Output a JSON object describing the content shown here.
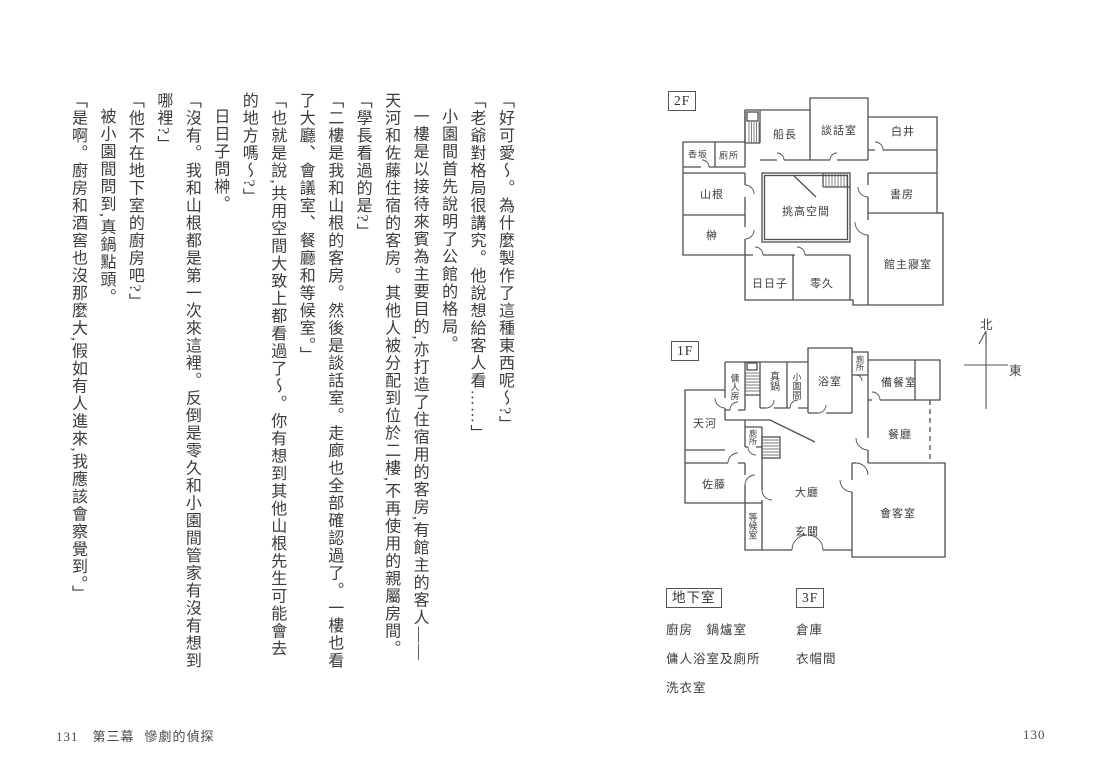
{
  "page_left": {
    "paragraphs": [
      {
        "text": "「好可愛〜。為什麼製作了這種東西呢〜?」",
        "indent": false
      },
      {
        "text": "「老爺對格局很講究。他說想給客人看……」",
        "indent": false
      },
      {
        "text": "小園間首先說明了公館的格局。",
        "indent": true
      },
      {
        "text": "一樓是以接待來賓為主要目的,亦打造了住宿用的客房,有館主的客人——天河和佐藤住宿的客房。其他人被分配到位於二樓,不再使用的親屬房間。",
        "indent": true
      },
      {
        "text": "「學長看過的是?」",
        "indent": false
      },
      {
        "text": "「二樓是我和山根的客房。然後是談話室。走廊也全部確認過了。一樓也看了大廳、會議室、餐廳和等候室。」",
        "indent": false
      },
      {
        "text": "「也就是說,共用空間大致上都看過了〜。你有想到其他山根先生可能會去的地方嗎〜?」",
        "indent": false
      },
      {
        "text": "日日子問榊。",
        "indent": true
      },
      {
        "text": "「沒有。我和山根都是第一次來這裡。反倒是零久和小園間管家有沒有想到哪裡?」",
        "indent": false
      },
      {
        "text": "「他不在地下室的廚房吧?」",
        "indent": false
      },
      {
        "text": "被小園間問到,真鍋點頭。",
        "indent": true
      },
      {
        "text": "「是啊。廚房和酒窖也沒那麼大,假如有人進來,我應該會察覺到。」",
        "indent": false
      }
    ],
    "footer": {
      "page_number": "131",
      "chapter": "第三幕",
      "title": "慘劇的偵探"
    }
  },
  "page_right": {
    "plans": [
      {
        "id": "2f",
        "label": "2F",
        "rooms": [
          {
            "name": "香坂",
            "x": 33,
            "y": 69,
            "fs": 9,
            "v": false
          },
          {
            "name": "廁所",
            "x": 64,
            "y": 70,
            "fs": 9,
            "v": false
          },
          {
            "name": "船長",
            "x": 120,
            "y": 49,
            "fs": 11,
            "v": false
          },
          {
            "name": "談話室",
            "x": 174,
            "y": 45,
            "fs": 11,
            "v": false
          },
          {
            "name": "白井",
            "x": 238,
            "y": 46,
            "fs": 11,
            "v": false
          },
          {
            "name": "山根",
            "x": 47,
            "y": 109,
            "fs": 11,
            "v": false
          },
          {
            "name": "榊",
            "x": 47,
            "y": 150,
            "fs": 11,
            "v": false
          },
          {
            "name": "挑高空間",
            "x": 141,
            "y": 126,
            "fs": 11,
            "v": false
          },
          {
            "name": "書房",
            "x": 237,
            "y": 109,
            "fs": 11,
            "v": false
          },
          {
            "name": "館主寢室",
            "x": 243,
            "y": 179,
            "fs": 11,
            "v": false
          },
          {
            "name": "日日子",
            "x": 105,
            "y": 198,
            "fs": 11,
            "v": false
          },
          {
            "name": "零久",
            "x": 157,
            "y": 198,
            "fs": 11,
            "v": false
          }
        ]
      },
      {
        "id": "1f",
        "label": "1F",
        "rooms": [
          {
            "name": "傭人房",
            "x": 75,
            "y": 57,
            "fs": 9,
            "v": true
          },
          {
            "name": "真鍋",
            "x": 113,
            "y": 51,
            "fs": 10,
            "v": true
          },
          {
            "name": "小園間",
            "x": 137,
            "y": 56,
            "fs": 9,
            "v": true
          },
          {
            "name": "浴室",
            "x": 170,
            "y": 51,
            "fs": 11,
            "v": false
          },
          {
            "name": "廁所",
            "x": 200,
            "y": 33,
            "fs": 8,
            "v": true
          },
          {
            "name": "備餐室",
            "x": 239,
            "y": 52,
            "fs": 11,
            "v": false
          },
          {
            "name": "餐廳",
            "x": 240,
            "y": 104,
            "fs": 11,
            "v": false
          },
          {
            "name": "天河",
            "x": 45,
            "y": 93,
            "fs": 11,
            "v": false
          },
          {
            "name": "廁所",
            "x": 93,
            "y": 107,
            "fs": 8,
            "v": true
          },
          {
            "name": "佐藤",
            "x": 54,
            "y": 154,
            "fs": 11,
            "v": false
          },
          {
            "name": "大廳",
            "x": 147,
            "y": 162,
            "fs": 11,
            "v": false
          },
          {
            "name": "玄關",
            "x": 147,
            "y": 201,
            "fs": 11,
            "v": false
          },
          {
            "name": "等候室",
            "x": 93,
            "y": 196,
            "fs": 9,
            "v": true
          },
          {
            "name": "會客室",
            "x": 238,
            "y": 183,
            "fs": 11,
            "v": false
          }
        ]
      }
    ],
    "compass": {
      "north": "北",
      "east": "東"
    },
    "legend": [
      {
        "label": "地下室",
        "items": [
          "廚房　鍋爐室",
          "傭人浴室及廁所",
          "洗衣室"
        ]
      },
      {
        "label": "3F",
        "items": [
          "倉庫",
          "衣帽間"
        ]
      }
    ],
    "page_number": "130"
  }
}
